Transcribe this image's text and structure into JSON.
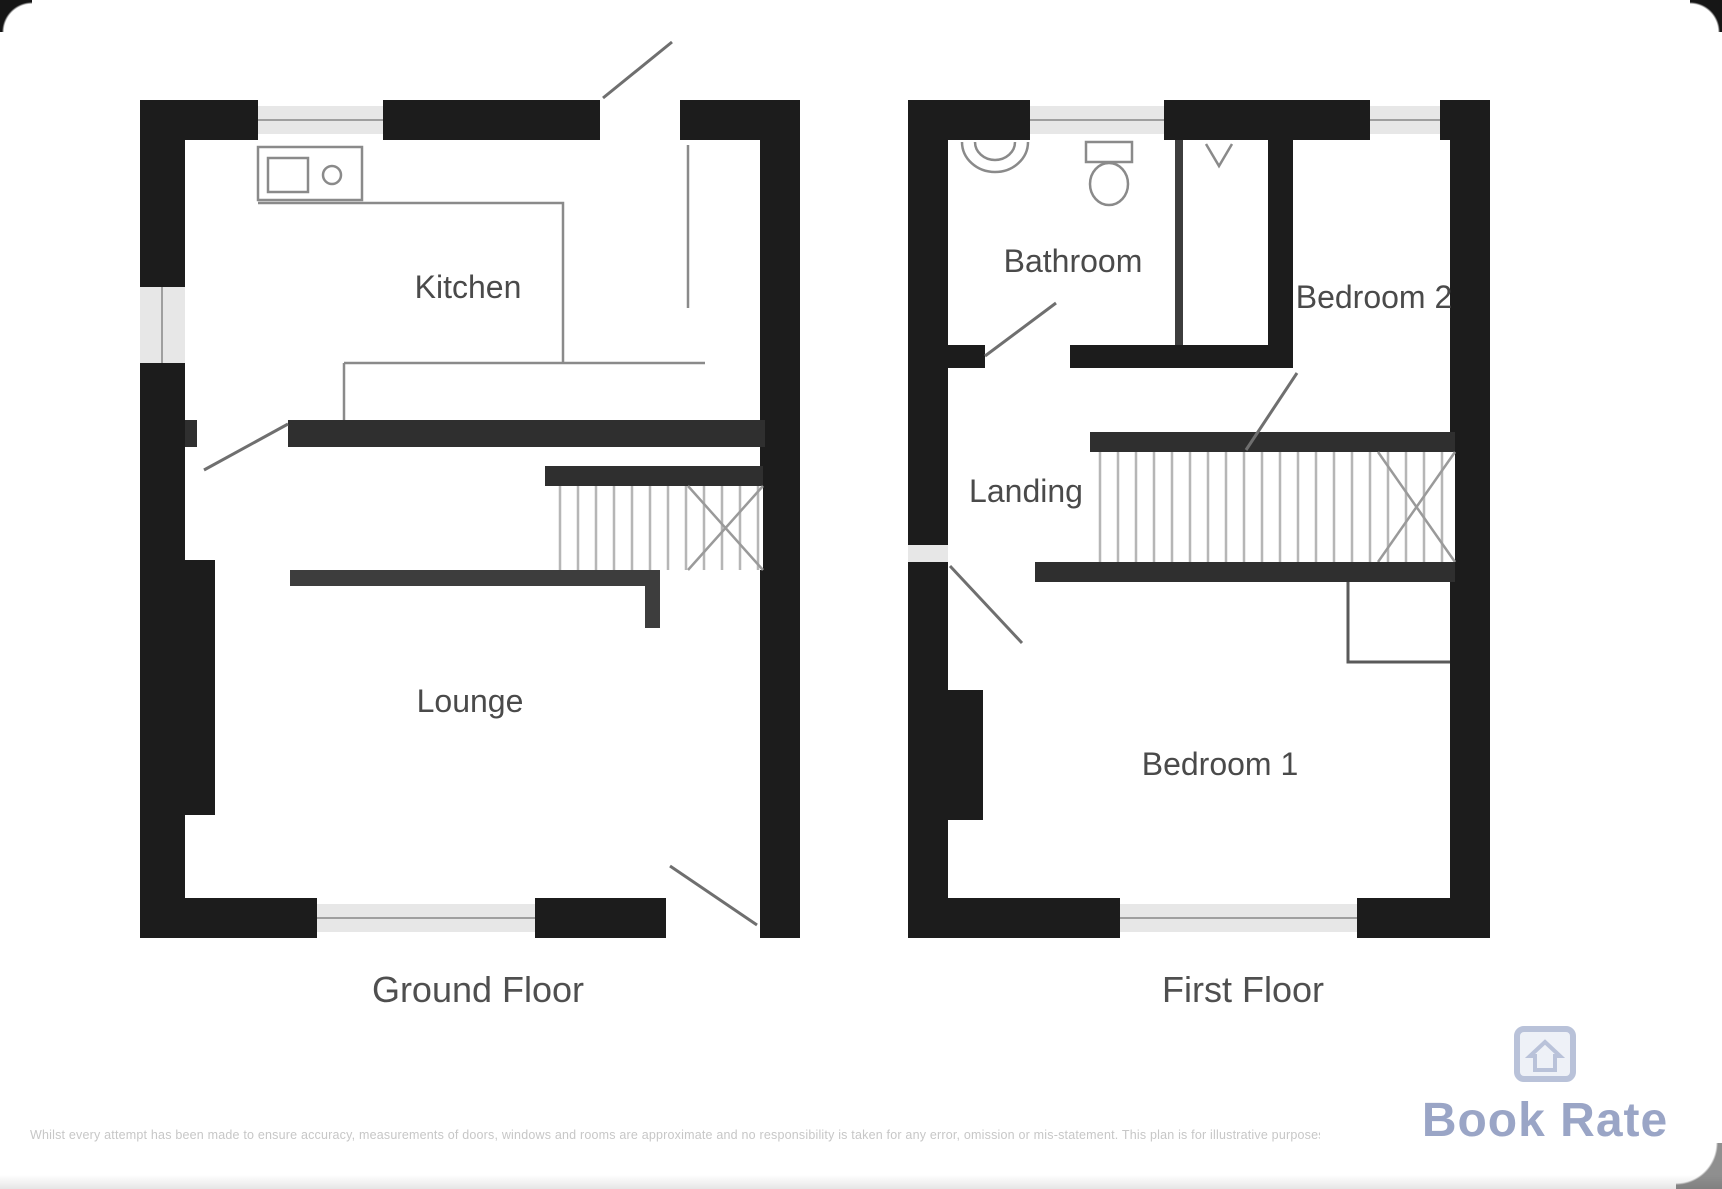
{
  "plans": [
    {
      "id": "ground-floor",
      "label": "Ground Floor",
      "rooms": [
        {
          "label": "Kitchen"
        },
        {
          "label": "Lounge"
        }
      ]
    },
    {
      "id": "first-floor",
      "label": "First Floor",
      "rooms": [
        {
          "label": "Bathroom"
        },
        {
          "label": "Bedroom 2"
        },
        {
          "label": "Landing"
        },
        {
          "label": "Bedroom 1"
        }
      ]
    }
  ],
  "footer": {
    "disclaimer": "Whilst every attempt has been made to ensure accuracy, measurements of doors, windows and rooms are approximate and no responsibility is taken for any error, omission or mis-statement. This plan is for illustrative purposes only.",
    "logo_text": "Book Rate"
  },
  "colors": {
    "wall": "#1c1c1c",
    "logo_blue": "#9aa5c6",
    "label_grey": "#4a4a4a"
  }
}
